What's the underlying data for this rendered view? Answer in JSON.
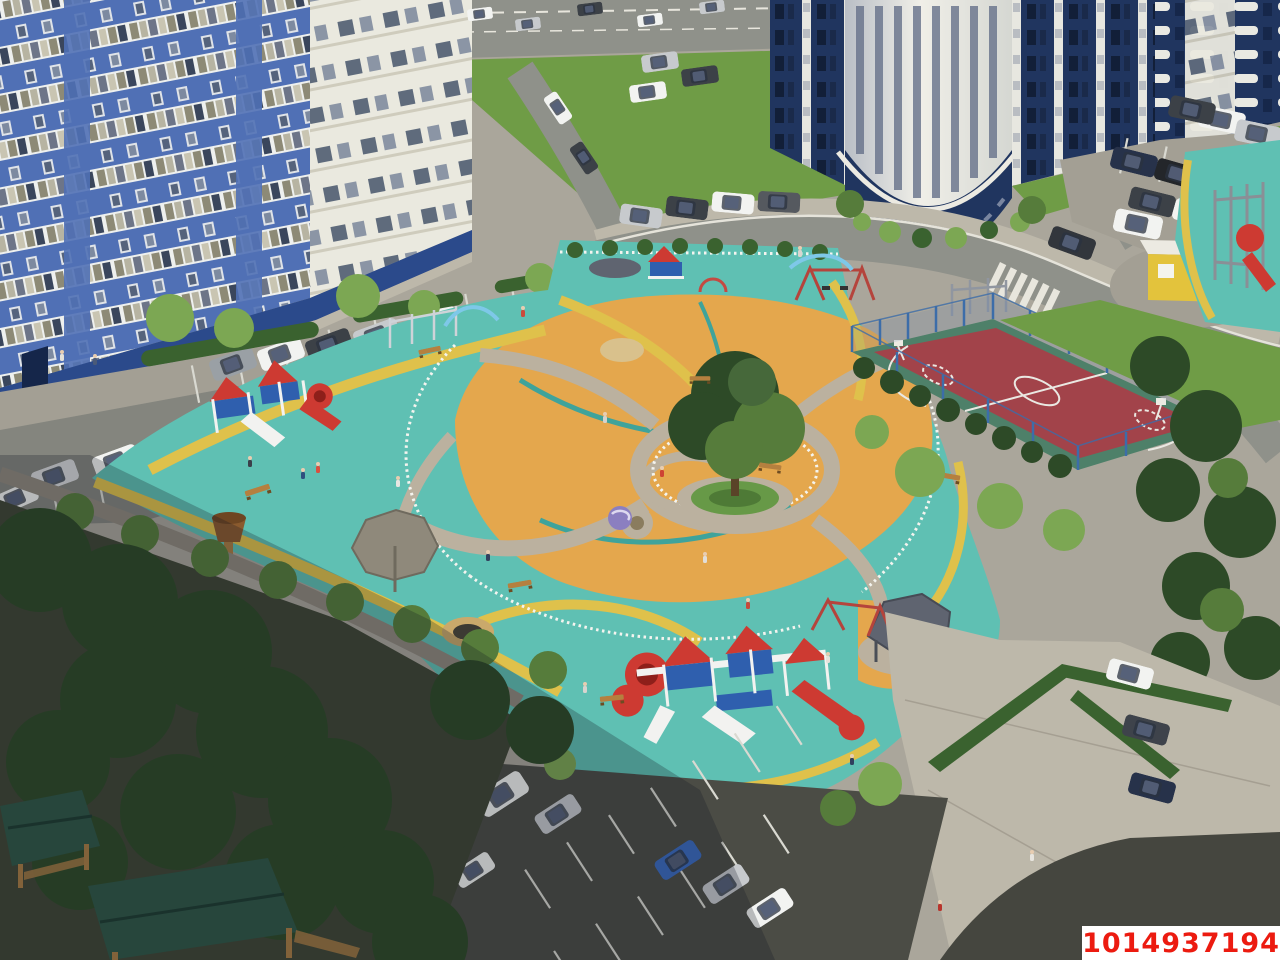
{
  "watermark": {
    "text": "1014937194"
  },
  "colors": {
    "base_pavement": "#aaa69b",
    "road": "#8f918a",
    "road_light": "#a39f94",
    "sidewalk": "#bdb8aa",
    "asphalt_dark": "#4b4c45",
    "asphalt_corner": "#45463f",
    "stall_line": "#d9d9d1",
    "grass": "#6f9c46",
    "hedge": "#3a622f",
    "tree_bright": "#7ca753",
    "tree_mid": "#567c3b",
    "tree_dark": "#2d4a27",
    "soil_dark": "#3e4634",
    "teal_rubber": "#5fc0b3",
    "teal_deep": "#3fa39b",
    "orange_rubber": "#e4a74d",
    "yellow_stripe": "#dfc14b",
    "stone_path": "#bbb19f",
    "sand": "#d9c18c",
    "fence_white": "#f4f4ef",
    "court_green": "#4e8069",
    "court_red": "#a2434a",
    "court_line": "#eae8e2",
    "fence_blue": "#3c6da9",
    "bldg_blue": "#5070b5",
    "bldg_blue_dark": "#2b4a8b",
    "bldg_navy": "#20355f",
    "bldg_white": "#eae9df",
    "kiosk_yellow": "#e3c33c",
    "kiosk_side": "#c7a42e",
    "gazebo_roof": "#2e5746",
    "wood": "#a97c43",
    "equip_red": "#cd3a32",
    "equip_blue": "#2f5fae",
    "equip_white": "#f2f2f0",
    "canopy_grey": "#8f897b",
    "canopy_dark": "#5f6470",
    "shadow": "rgba(18,24,34,0.26)",
    "watermark_red": "#ec1b10",
    "watermark_bg": "#ffffff"
  },
  "scene": {
    "type": "aerial-3d-render",
    "subject": "residential complex courtyard",
    "landmarks": [
      "blue-and-white apartment building",
      "round white tower with navy base",
      "navy apartment block with white balconies",
      "central playground with teal and orange rubber surface",
      "large central tree with hedge ring",
      "red-and-white play structures",
      "basketball court with blue fence",
      "yellow kiosk",
      "parking lots with cars",
      "wooden gazebos with green roofs",
      "paved plaza with hedges"
    ]
  }
}
